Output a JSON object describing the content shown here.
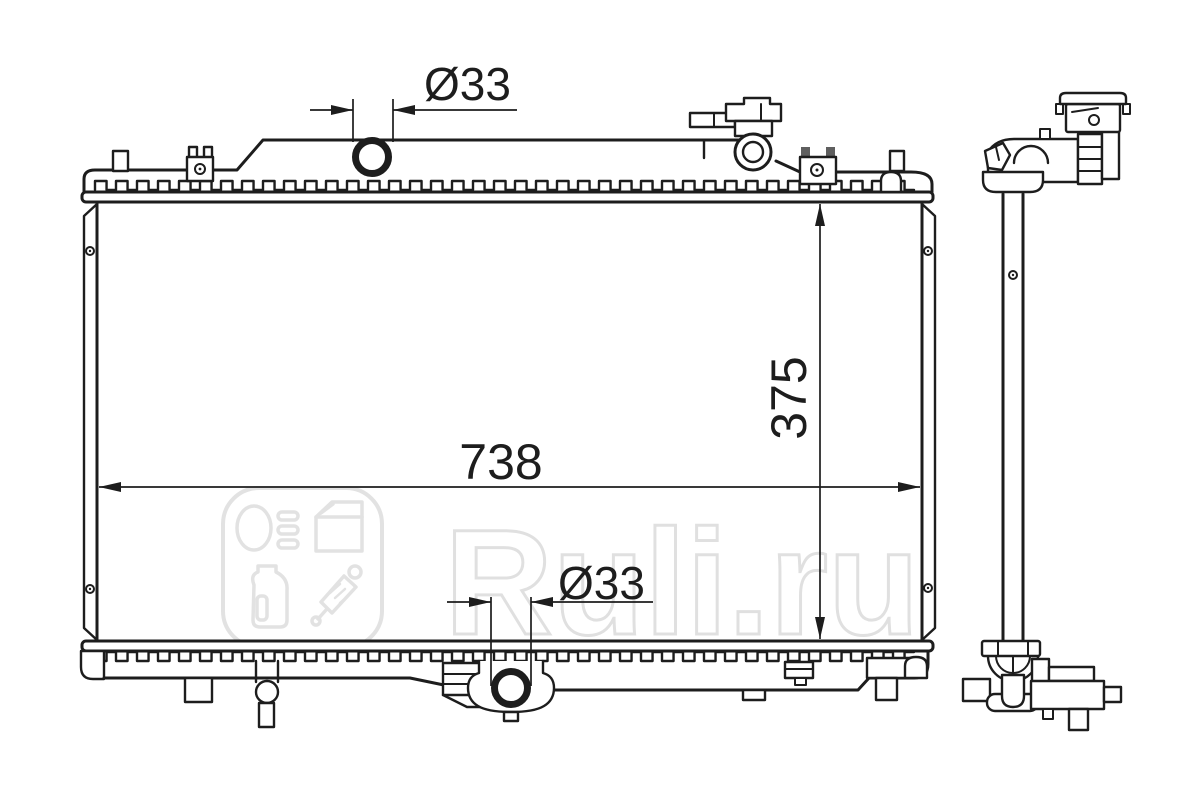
{
  "watermark": {
    "brand": "Ruli.ru",
    "color": "#e2e2e2",
    "logo_icons": [
      "headlight-icon",
      "car-door-icon",
      "oil-canister-icon",
      "shock-absorber-icon"
    ]
  },
  "dimensions": {
    "top_pipe_diameter": "Ø33",
    "overall_width": "738",
    "overall_height": "375",
    "bottom_pipe_diameter": "Ø33"
  },
  "colors": {
    "line": "#1d1d1d",
    "watermark": "#e2e2e2",
    "background": "#ffffff"
  }
}
